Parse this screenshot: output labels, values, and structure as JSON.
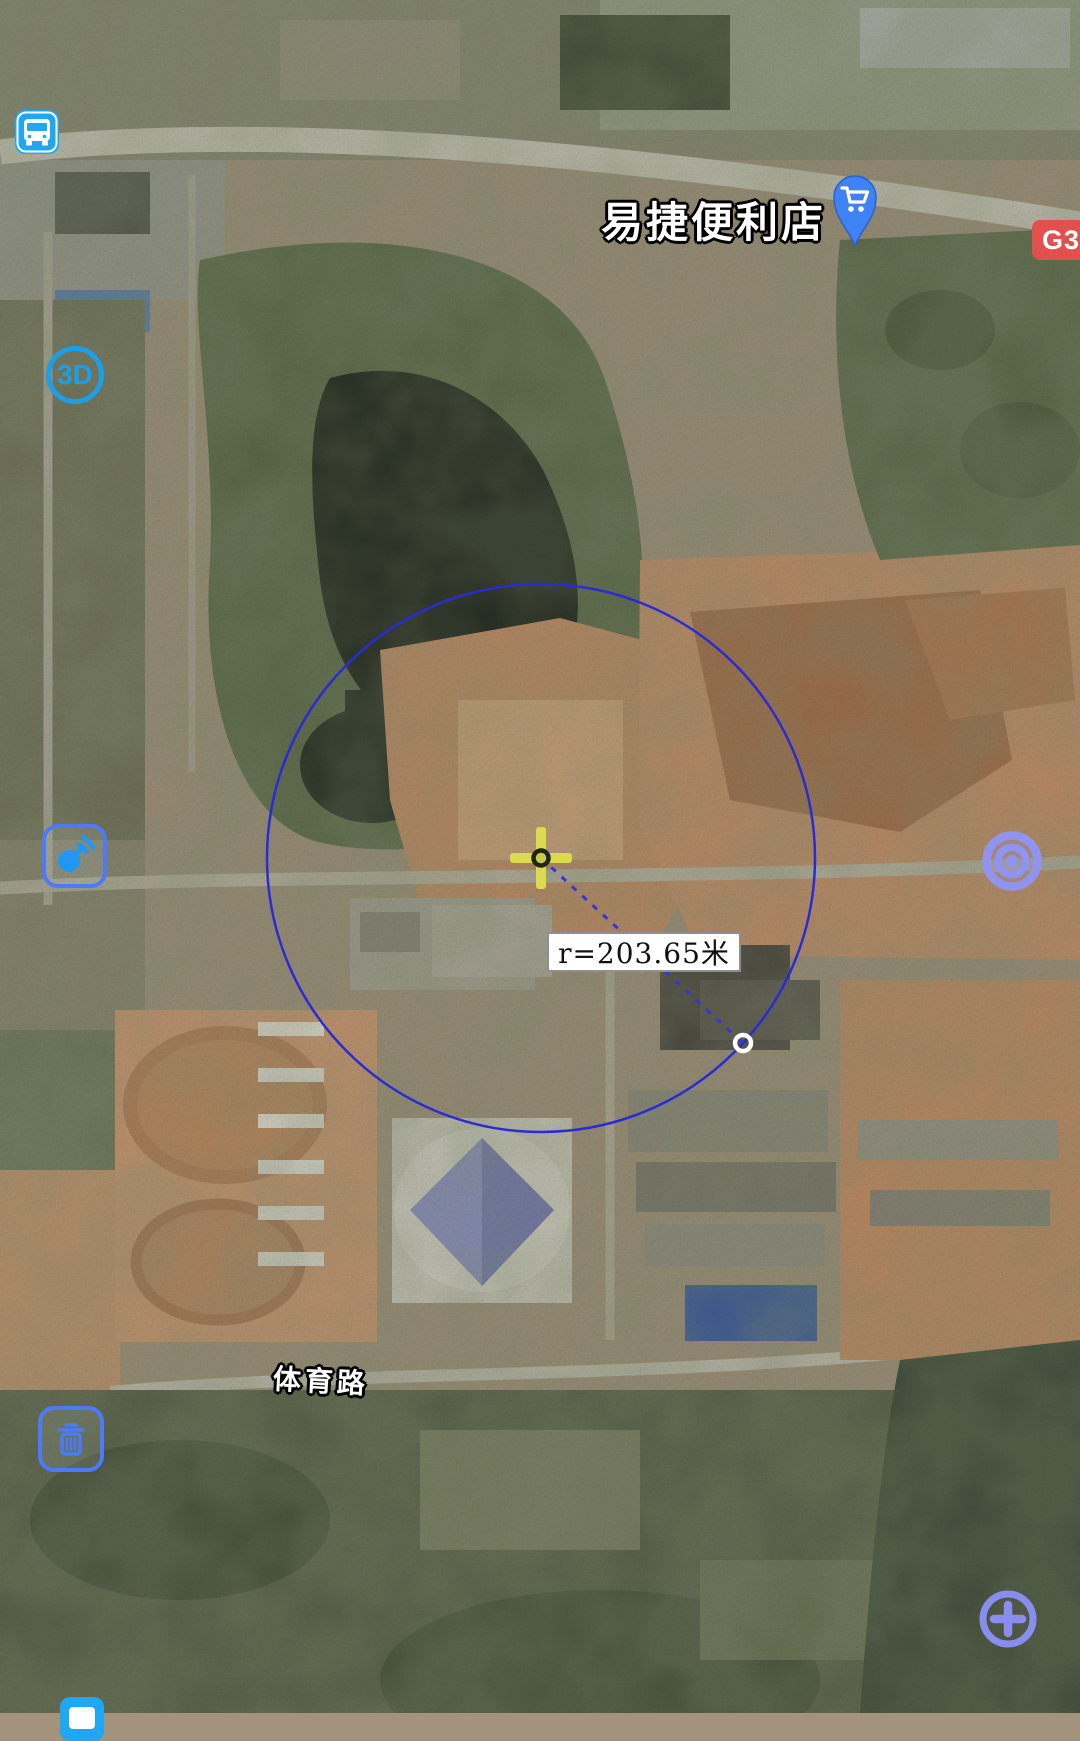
{
  "map": {
    "poi_label": "易捷便利店",
    "highway_badge": "G32",
    "road_label": "体育路"
  },
  "measurement": {
    "radius_label": "r=203.65米",
    "circle_color": "#2b2bd5",
    "crosshair_color": "#dcda4e"
  },
  "controls": {
    "bus_stop": {
      "icon": "bus-icon",
      "color": "#1fa7f2"
    },
    "view_3d": {
      "label": "3D",
      "color": "#1b9fe8"
    },
    "satellite_signal": {
      "icon": "satellite-dish-icon",
      "color": "#4d7bf7"
    },
    "locate_target": {
      "icon": "target-rings-icon",
      "color": "#9094ef"
    },
    "delete_measure": {
      "icon": "trash-icon",
      "color": "#4d7bf7"
    },
    "zoom_in": {
      "icon": "plus-icon",
      "color": "#8a8df0"
    },
    "poi_pin": {
      "icon": "shopping-cart-pin-icon",
      "color": "#3e82f4"
    }
  }
}
